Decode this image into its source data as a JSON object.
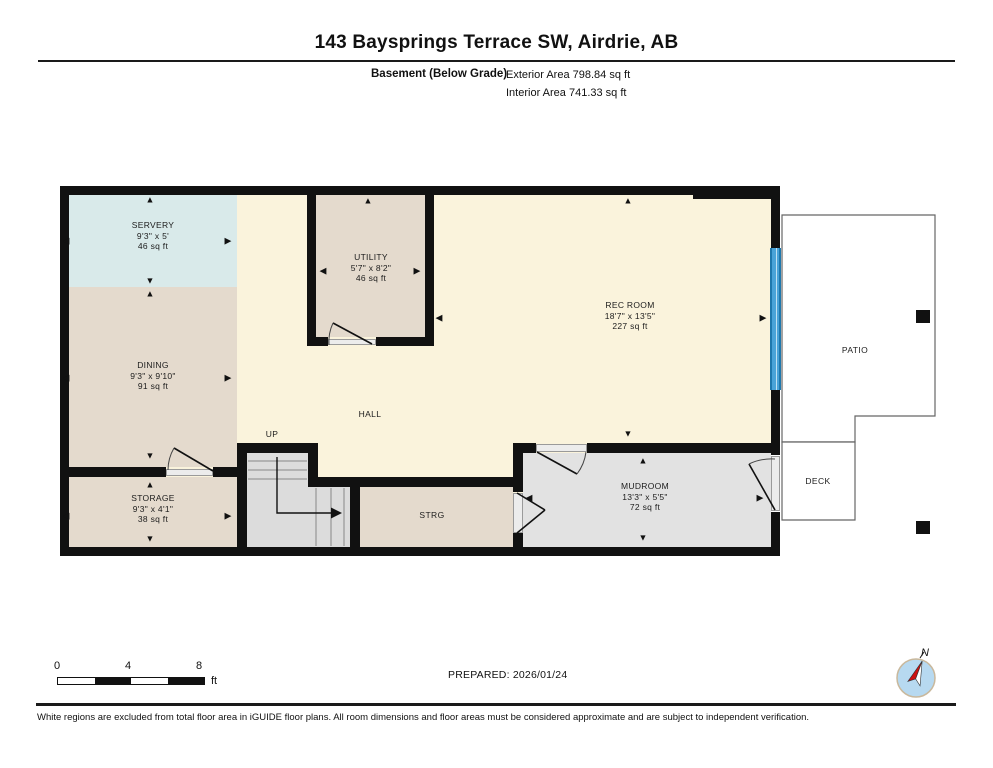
{
  "header": {
    "title": "143 Baysprings Terrace SW, Airdrie, AB",
    "floor_name": "Basement (Below Grade)",
    "exterior_area": "Exterior Area 798.84 sq ft",
    "interior_area": "Interior Area 741.33 sq ft"
  },
  "rooms": {
    "servery": {
      "name": "SERVERY",
      "dims": "9'3\" x 5'",
      "area": "46 sq ft"
    },
    "utility": {
      "name": "UTILITY",
      "dims": "5'7\" x 8'2\"",
      "area": "46 sq ft"
    },
    "rec_room": {
      "name": "REC ROOM",
      "dims": "18'7\" x 13'5\"",
      "area": "227 sq ft"
    },
    "dining": {
      "name": "DINING",
      "dims": "9'3\" x 9'10\"",
      "area": "91 sq ft"
    },
    "storage": {
      "name": "STORAGE",
      "dims": "9'3\" x 4'1\"",
      "area": "38 sq ft"
    },
    "mudroom": {
      "name": "MUDROOM",
      "dims": "13'3\" x 5'5\"",
      "area": "72 sq ft"
    }
  },
  "labels": {
    "hall": "HALL",
    "up": "UP",
    "strg": "STRG",
    "patio": "PATIO",
    "deck": "DECK",
    "north": "N"
  },
  "scale": {
    "tick0": "0",
    "tick4": "4",
    "tick8": "8",
    "unit": "ft"
  },
  "prepared": "PREPARED: 2026/01/24",
  "disclaimer": "White regions are excluded from total floor area in iGUIDE floor plans. All room dimensions and floor areas must be considered approximate and are subject to independent verification.",
  "colors": {
    "wall": "#111111",
    "cream": "#faf3dc",
    "teal": "#d9eaea",
    "beige": "#e4dacd",
    "stairgray": "#dcdcdc",
    "mudgray": "#e2e2e2",
    "sill": "#ececec",
    "winblue": "#4aa3d8",
    "winedge": "#1f78ad",
    "line": "#666666",
    "ink": "#1a1a1a",
    "compass_blue": "#b7d9f0",
    "needle_red": "#cc1111"
  }
}
